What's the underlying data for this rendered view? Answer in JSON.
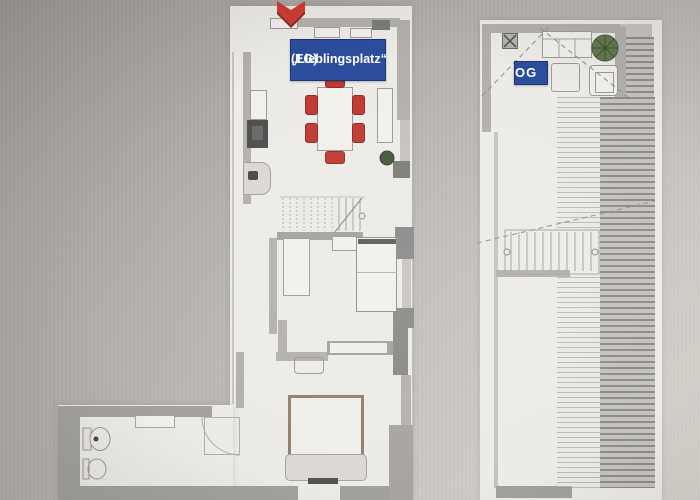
{
  "labels": {
    "eg_line1": "„Lieblingsplatz“",
    "eg_line2": "(EG)",
    "og": "OG"
  },
  "icons": {
    "marker": "red-chevron-location-marker",
    "eg_plant": "potted-plant-icon",
    "og_plant": "potted-plant-icon",
    "speaker_box": "vent-box-icon"
  },
  "colors": {
    "label_background": "#2b4d9c",
    "label_border": "#1a3576",
    "label_text": "#ffffff",
    "marker_red": "#ce3a31",
    "chair_red": "#bf3a31",
    "plant_green": "#4c6442",
    "wall_light": "#b3b0ac",
    "wall_dark": "#8a8886",
    "paper_white": "#edebe7"
  },
  "plan_items": {
    "eg": [
      "kitchen-row",
      "dining-table",
      "six-red-chairs",
      "staircase",
      "wardrobe",
      "single-bed",
      "bathroom-toilet-sink",
      "shower",
      "double-bed"
    ],
    "og": [
      "sofa",
      "coffee-table",
      "armchair",
      "plant",
      "staircase",
      "roof-hatching"
    ]
  }
}
